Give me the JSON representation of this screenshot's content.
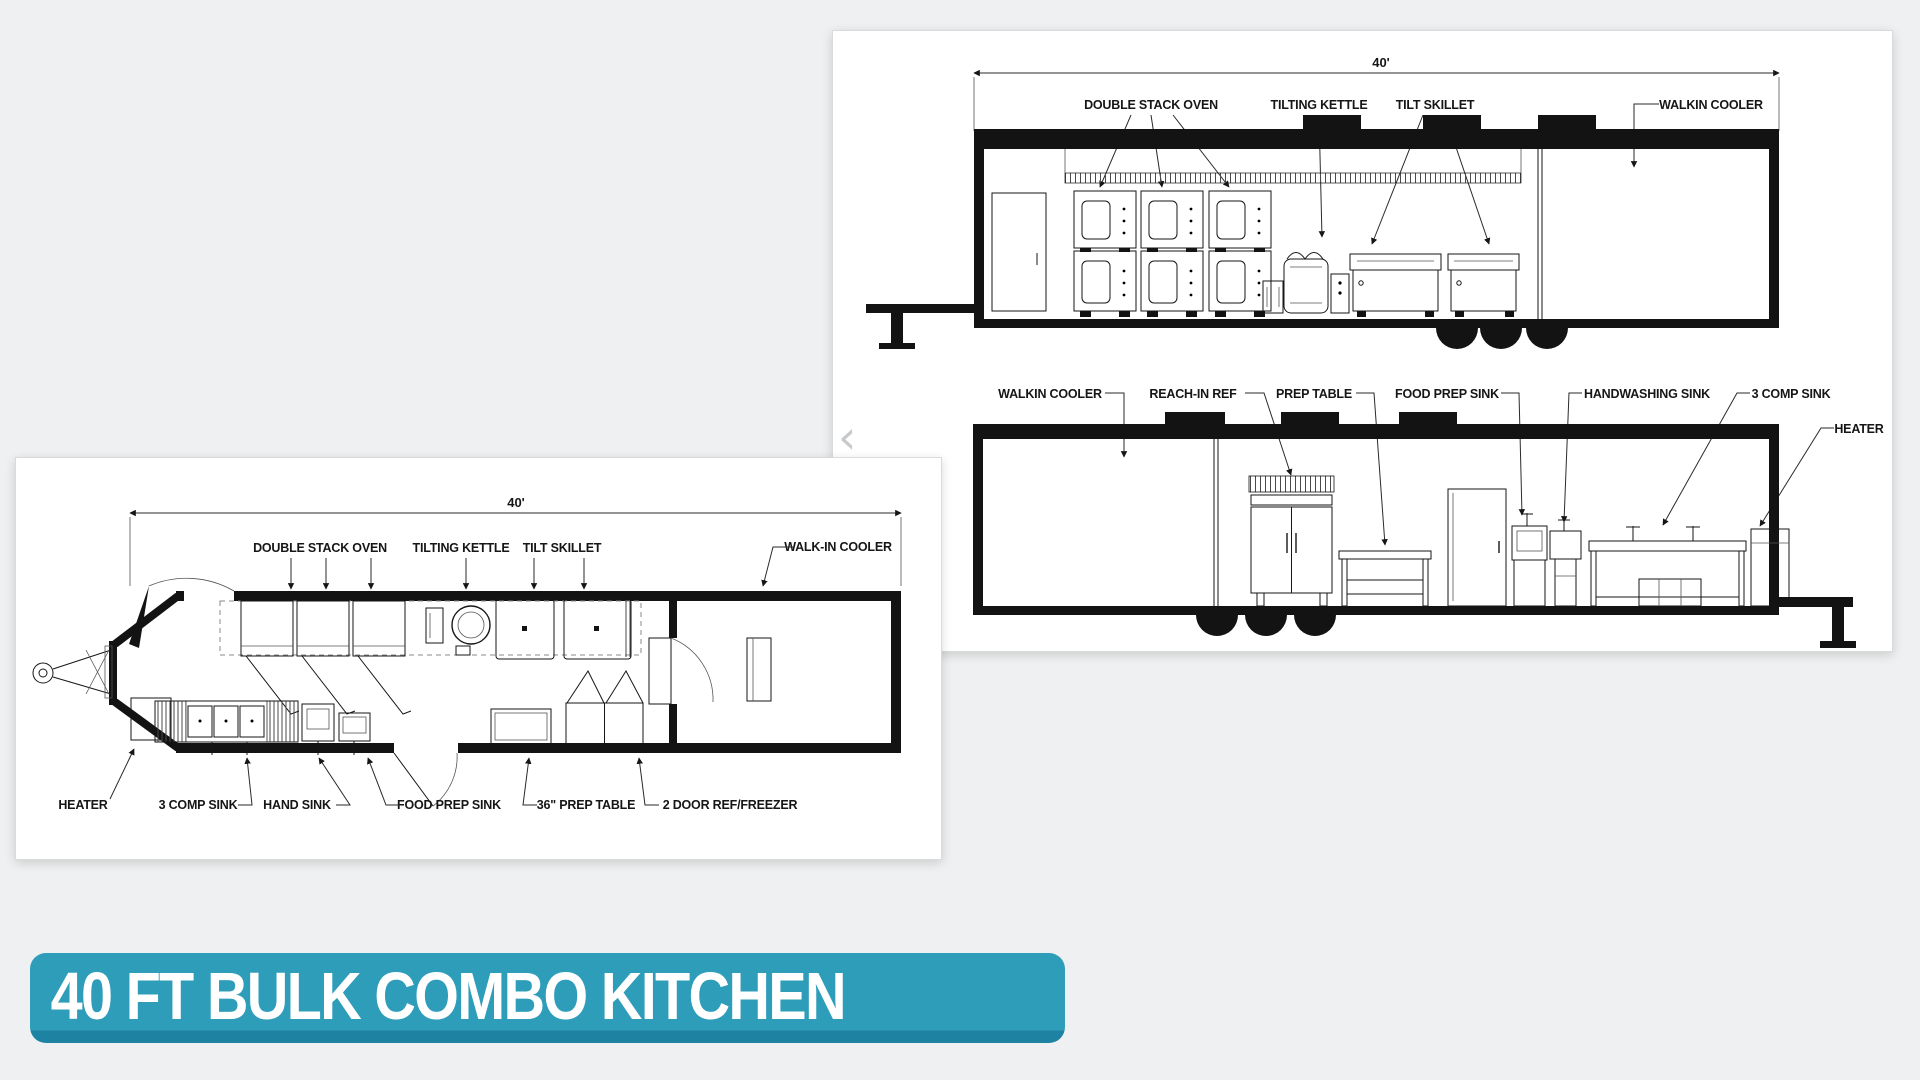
{
  "page": {
    "background": "#eef0f1"
  },
  "carousel": {
    "prev_icon": "‹"
  },
  "banner": {
    "text": "40 FT BULK COMBO KITCHEN",
    "bg": "#2d9db9",
    "edge": "#1e83a2",
    "text_color": "#ffffff"
  },
  "elevations": {
    "dimension": "40'",
    "top": {
      "labels": {
        "double_stack_oven": "DOUBLE STACK OVEN",
        "tilting_kettle": "TILTING KETTLE",
        "tilt_skillet": "TILT SKILLET",
        "walkin_cooler": "WALKIN COOLER"
      }
    },
    "bottom": {
      "labels": {
        "walkin_cooler": "WALKIN COOLER",
        "reach_in_ref": "REACH-IN REF",
        "prep_table": "PREP TABLE",
        "food_prep_sink": "FOOD PREP SINK",
        "handwashing_sink": "HANDWASHING SINK",
        "comp_sink_3": "3 COMP SINK",
        "heater": "HEATER"
      }
    }
  },
  "plan": {
    "dimension": "40'",
    "top_labels": {
      "double_stack_oven": "DOUBLE STACK OVEN",
      "tilting_kettle": "TILTING KETTLE",
      "tilt_skillet": "TILT SKILLET",
      "walk_in_cooler": "WALK-IN COOLER"
    },
    "bottom_labels": {
      "heater": "HEATER",
      "comp_sink_3": "3 COMP SINK",
      "hand_sink": "HAND SINK",
      "food_prep_sink": "FOOD PREP SINK",
      "prep_table_36": "36\" PREP TABLE",
      "two_door_ref_freezer": "2 DOOR REF/FREEZER"
    }
  }
}
